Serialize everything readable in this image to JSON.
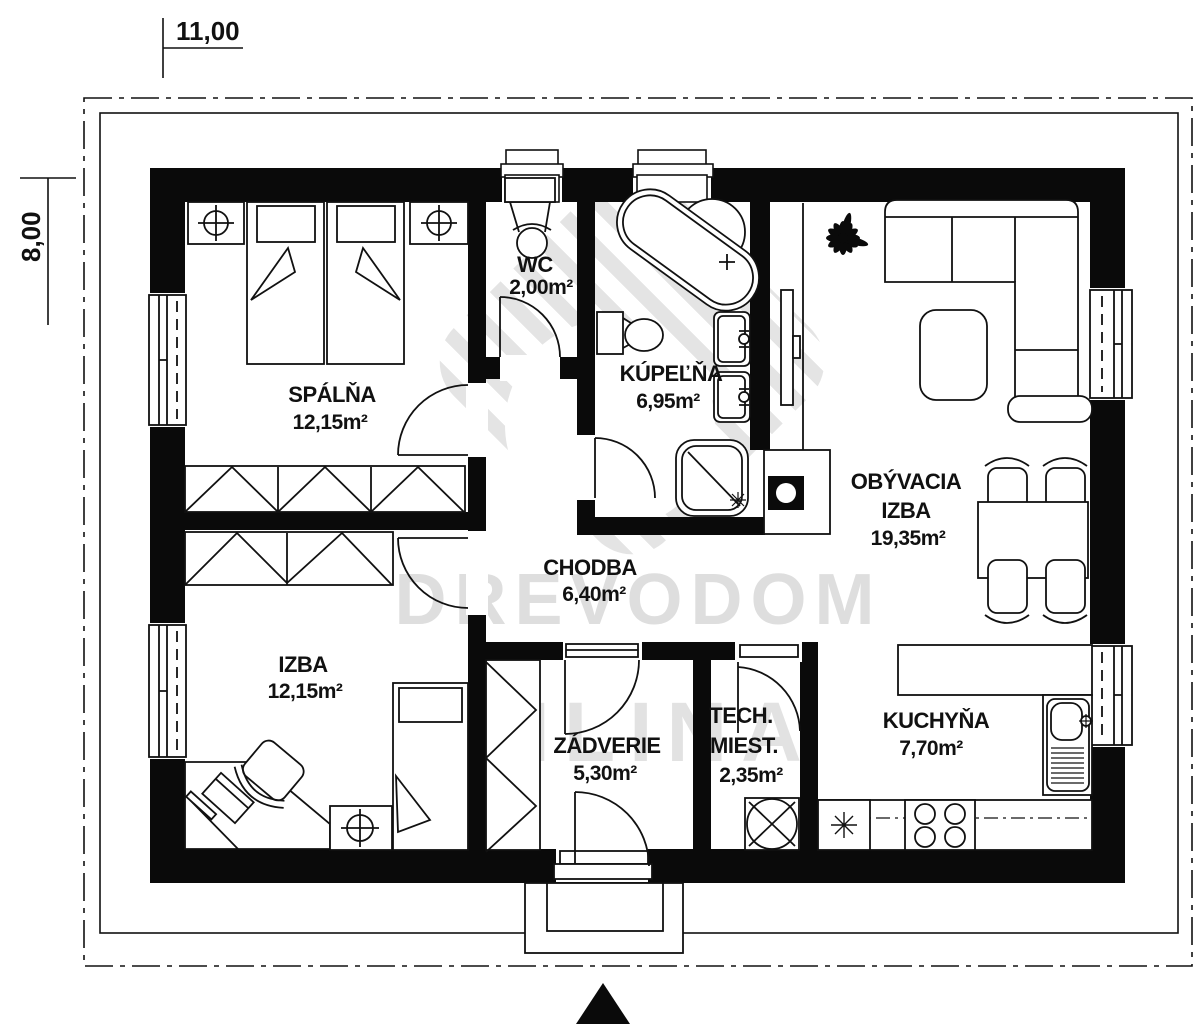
{
  "dims": {
    "width_label": "11,00",
    "height_label": "8,00"
  },
  "watermark": {
    "line1": "DREVODOM",
    "line2": "ŽILINA"
  },
  "rooms": [
    {
      "id": "spalna",
      "name": "SPÁLŇA",
      "area": "12,15m²"
    },
    {
      "id": "wc",
      "name": "WC",
      "area": "2,00m²"
    },
    {
      "id": "kupelna",
      "name": "KÚPEĽŇA",
      "area": "6,95m²"
    },
    {
      "id": "obyvacia",
      "name": "OBÝVACIA",
      "name2": "IZBA",
      "area": "19,35m²"
    },
    {
      "id": "chodba",
      "name": "CHODBA",
      "area": "6,40m²"
    },
    {
      "id": "izba",
      "name": "IZBA",
      "area": "12,15m²"
    },
    {
      "id": "zadverie",
      "name": "ZÁDVERIE",
      "area": "5,30m²"
    },
    {
      "id": "tech",
      "name": "TECH.",
      "name2": "MIEST.",
      "area": "2,35m²"
    },
    {
      "id": "kuchyna",
      "name": "KUCHYŇA",
      "area": "7,70m²"
    }
  ]
}
